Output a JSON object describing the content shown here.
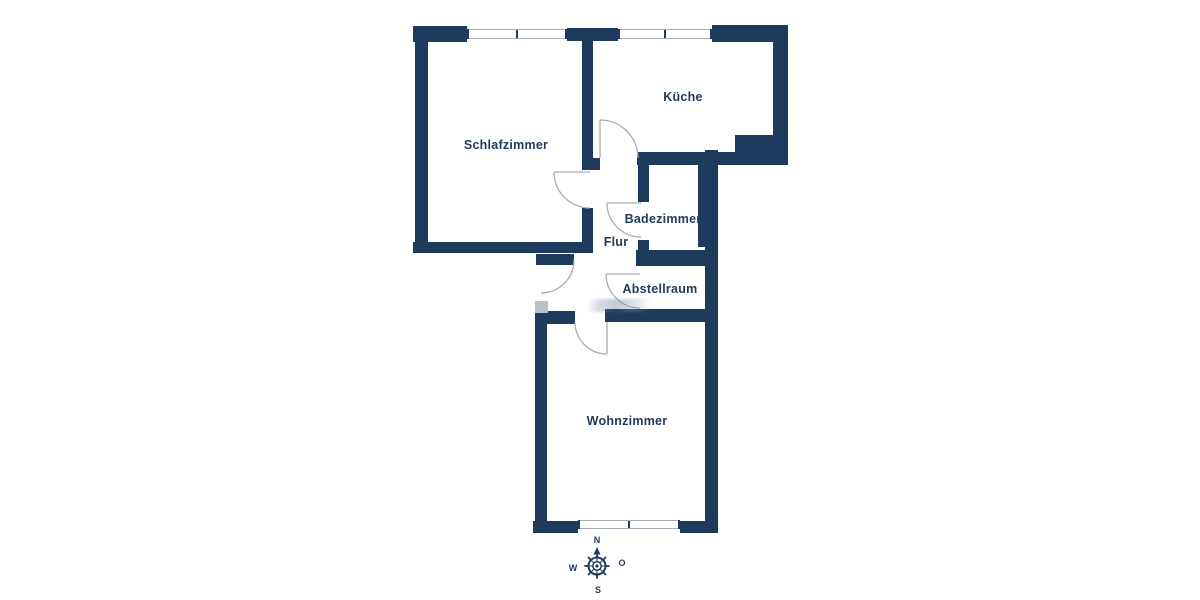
{
  "colors": {
    "wall": "#1e3a5c",
    "line": "#a6adb8",
    "threshold": "#b9c0c8",
    "text": "#1e3a5c",
    "background": "#ffffff"
  },
  "rooms": [
    {
      "id": "schlafzimmer",
      "label": "Schlafzimmer"
    },
    {
      "id": "kueche",
      "label": "Küche"
    },
    {
      "id": "badezimmer",
      "label": "Badezimmer"
    },
    {
      "id": "flur",
      "label": "Flur"
    },
    {
      "id": "abstellraum",
      "label": "Abstellraum"
    },
    {
      "id": "wohnzimmer",
      "label": "Wohnzimmer"
    }
  ],
  "compass": {
    "north": "N",
    "east": "O",
    "south": "S",
    "west": "W"
  }
}
